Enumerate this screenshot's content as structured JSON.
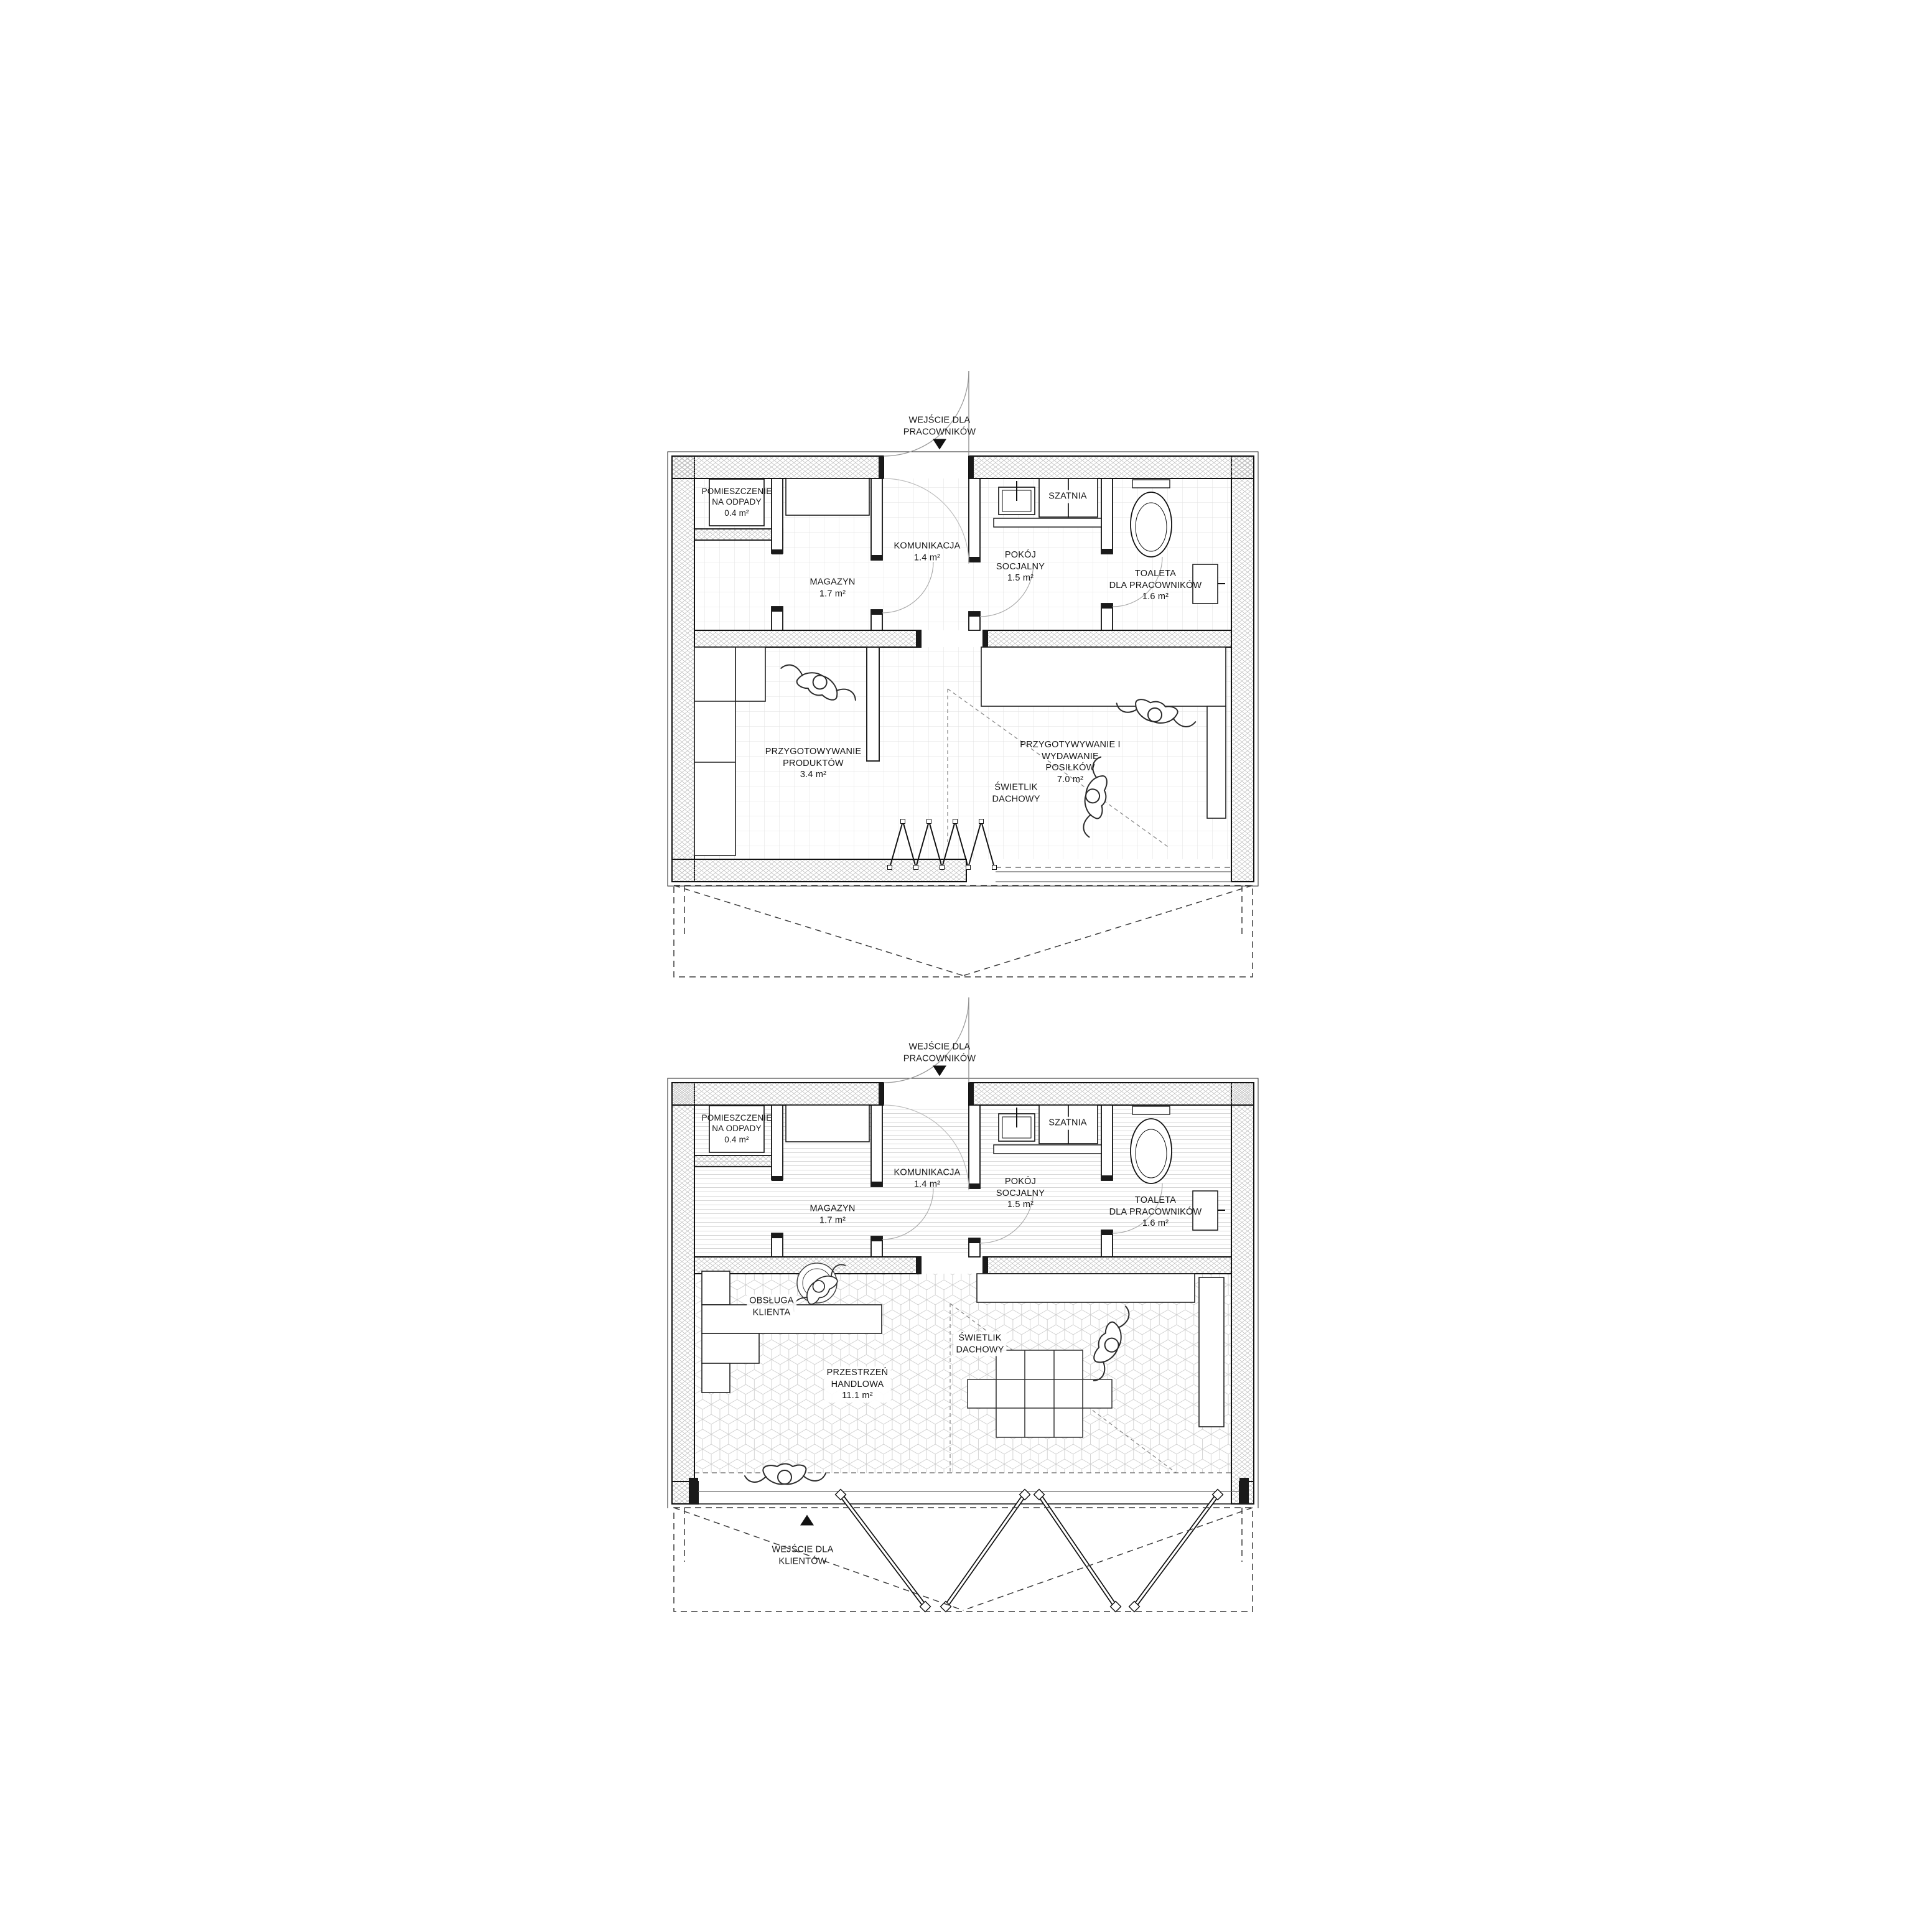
{
  "colors": {
    "ink": "#161616",
    "wall_hatch": "#b9b9b9",
    "tile_grid": "#e0e0e0",
    "stripe_floor": "#d4d4d4",
    "cube_floor": "#cfcfcf",
    "door_arc": "#a6a6a6",
    "canopy_dash": "#3a3a3a"
  },
  "plan_top": {
    "entrance_label": "WEJŚCIE DLA\nPRACOWNIKÓW",
    "rooms": {
      "waste": "POMIESZCZENIE\nNA ODPADY\n0.4 m²",
      "storage": "MAGAZYN\n1.7 m²",
      "circulation": "KOMUNIKACJA\n1.4 m²",
      "social": "POKÓJ\nSOCJALNY\n1.5 m²",
      "cloakroom": "SZATNIA",
      "toilet": "TOALETA\nDLA PRACOWNIKÓW\n1.6 m²",
      "product_prep": "PRZYGOTOWYWANIE\nPRODUKTÓW\n3.4 m²",
      "meal_prep": "PRZYGOTYWYWANIE I\nWYDAWANIE\nPOSIŁKÓW\n7.0 m²",
      "skylight": "ŚWIETLIK\nDACHOWY"
    }
  },
  "plan_bottom": {
    "entrance_label": "WEJŚCIE DLA\nPRACOWNIKÓW",
    "customer_entrance_label": "WEJŚCIE DLA\nKLIENTÓW",
    "rooms": {
      "waste": "POMIESZCZENIE\nNA ODPADY\n0.4 m²",
      "storage": "MAGAZYN\n1.7 m²",
      "circulation": "KOMUNIKACJA\n1.4 m²",
      "social": "POKÓJ\nSOCJALNY\n1.5 m²",
      "cloakroom": "SZATNIA",
      "toilet": "TOALETA\nDLA PRACOWNIKÓW\n1.6 m²",
      "customer_service": "OBSŁUGA\nKLIENTA",
      "retail": "PRZESTRZEŃ\nHANDLOWA\n11.1 m²",
      "skylight": "ŚWIETLIK\nDACHOWY"
    }
  }
}
